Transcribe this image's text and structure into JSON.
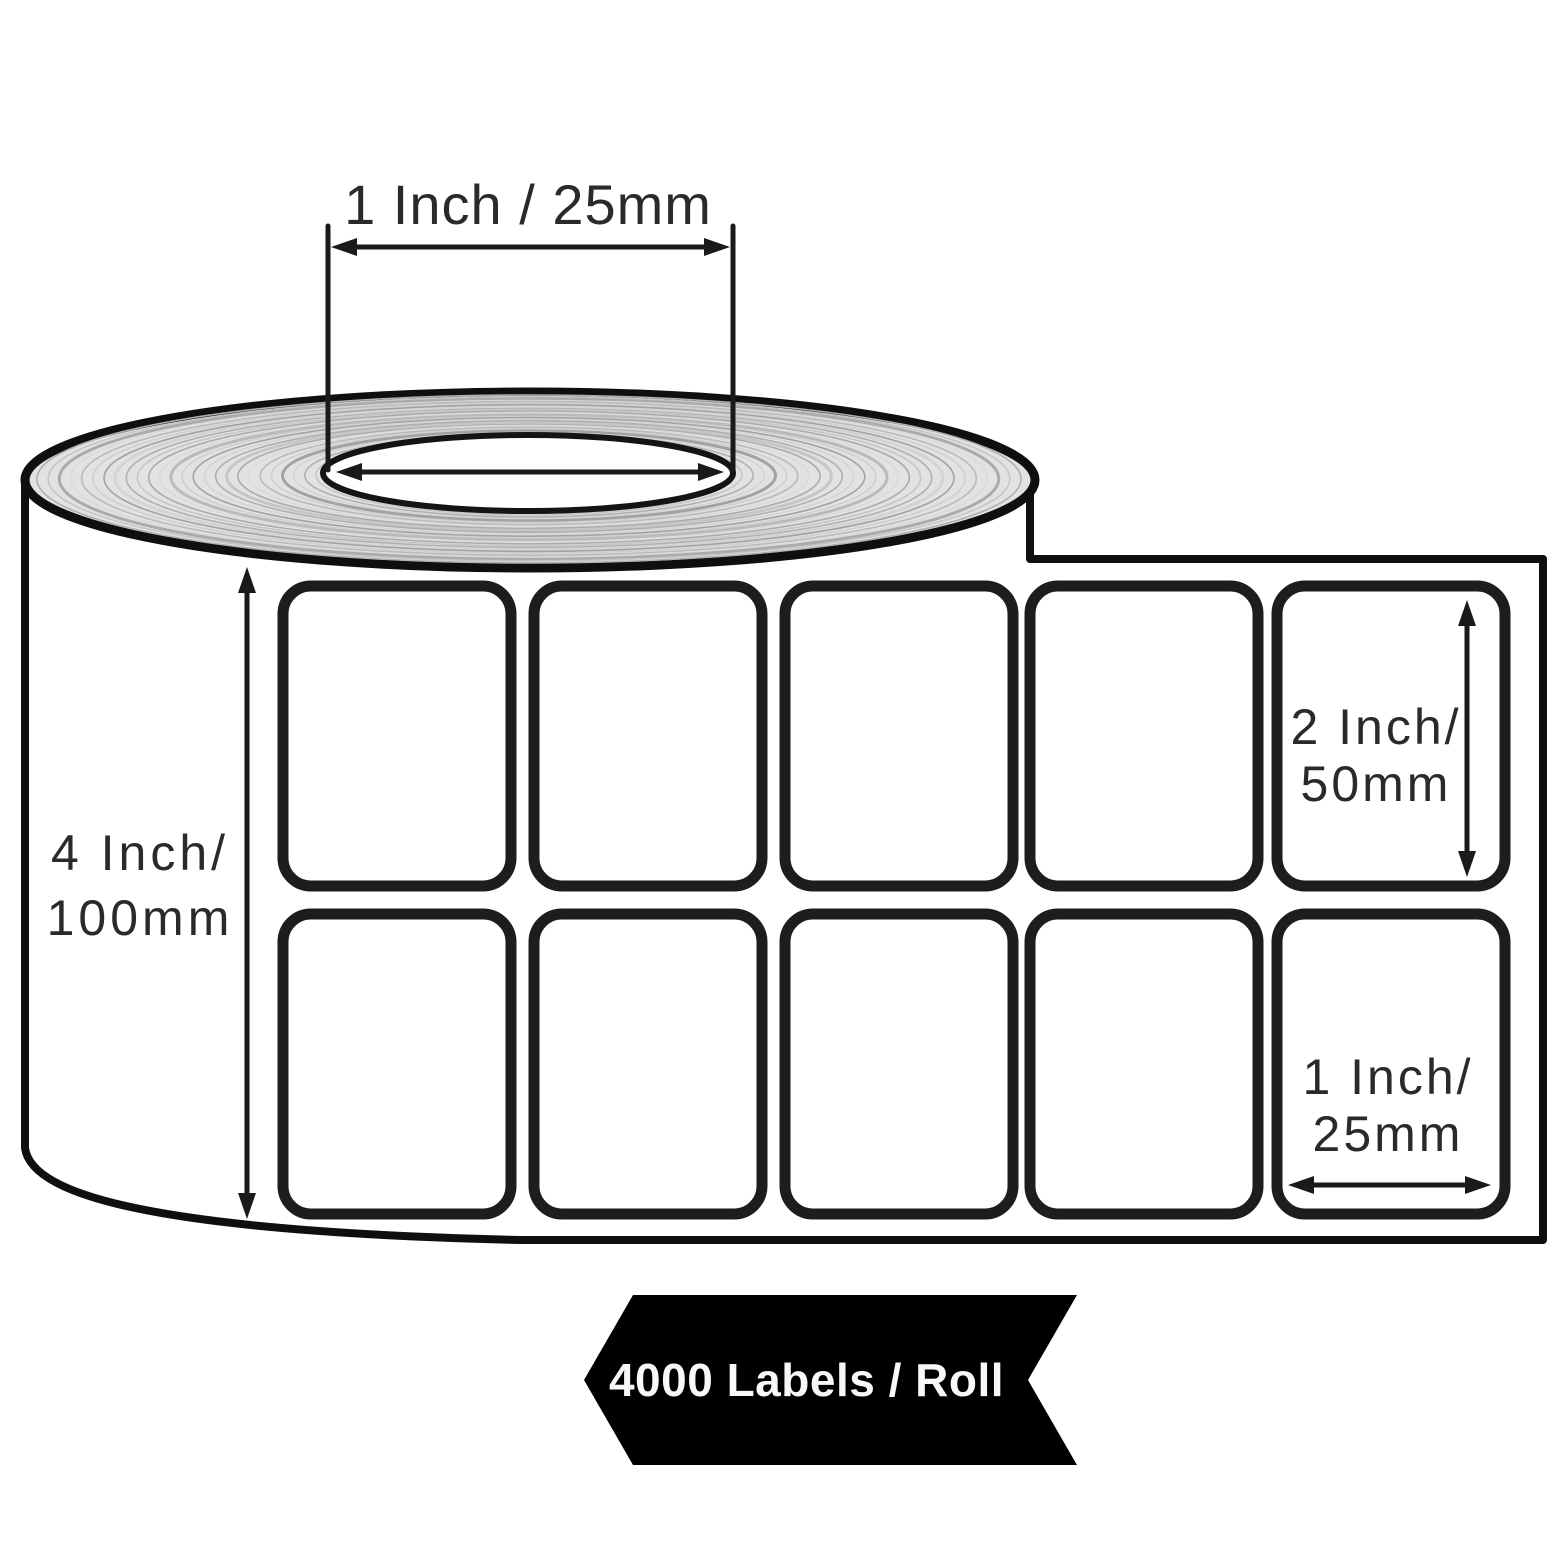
{
  "diagram": {
    "core_dimension_label": "1 Inch / 25mm",
    "roll_width_label": {
      "line1": "4 Inch/",
      "line2": "100mm"
    },
    "label_height_label": {
      "line1": "2 Inch/",
      "line2": "50mm"
    },
    "label_width_label": {
      "line1": "1 Inch/",
      "line2": "25mm"
    },
    "banner_label": "4000 Labels / Roll",
    "labels_grid": {
      "rows": 2,
      "columns": 5,
      "total_labels": 10
    },
    "colors": {
      "outline": "#111111",
      "dimension_text": "#2a2a2a",
      "roll_fill": "#e2e2e2",
      "banner_background": "#000000",
      "banner_text": "#f8f8f8",
      "background": "#ffffff"
    }
  }
}
